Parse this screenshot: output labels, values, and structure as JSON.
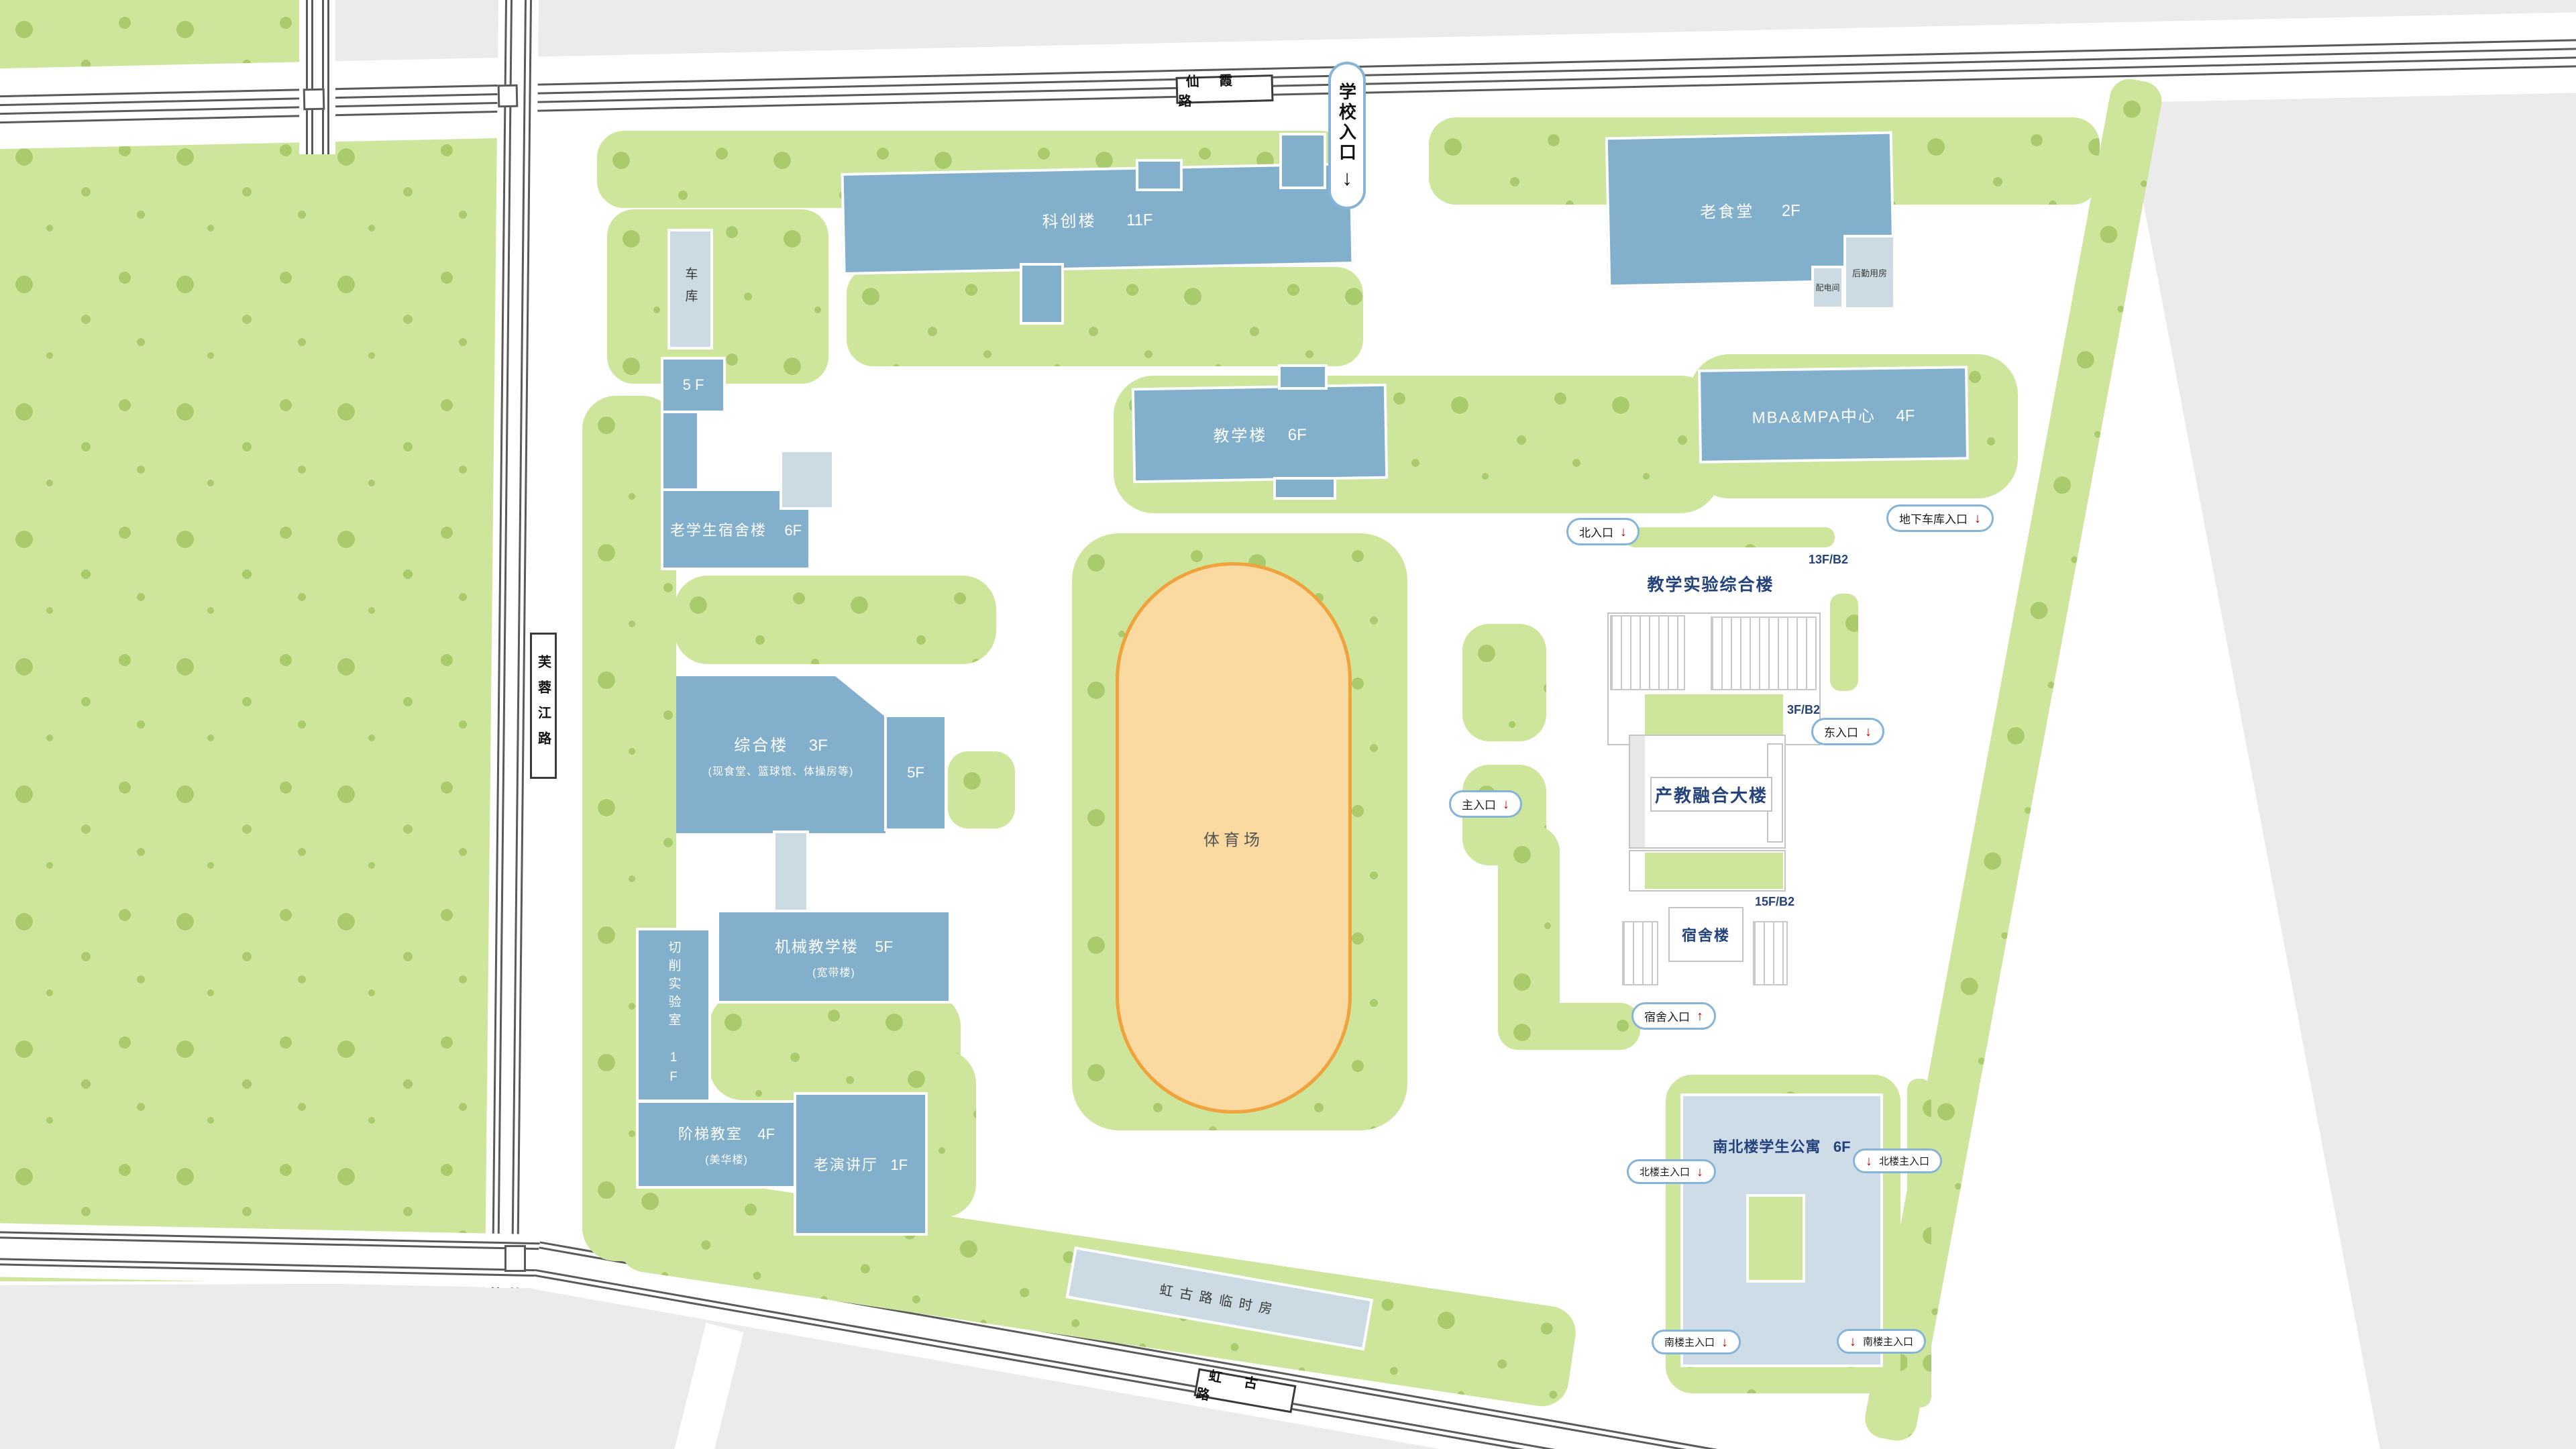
{
  "colors": {
    "campus_green": "#CDE69C",
    "tree_dot": "#A9CB6B",
    "building_blue": "#82AFCC",
    "building_light": "#CBDAE3",
    "apartment_light": "#CDDCE6",
    "outside_gray": "#EBEBEB",
    "stadium_fill": "#FBDAA1",
    "stadium_border": "#F0A23C",
    "navy_text": "#24427C",
    "road_line": "#5A5A5A",
    "pill_border": "#86B4D8",
    "arrow_red": "#C00000"
  },
  "roads": {
    "top": {
      "label": "仙  霞  路"
    },
    "left": {
      "label": "芙蓉江路"
    },
    "bottom": {
      "label": "虹  古  路"
    }
  },
  "school_entrance": {
    "label": "学校入口",
    "arrow": "↓"
  },
  "buildings": {
    "kechuang": {
      "name": "科创楼",
      "floors": "11F"
    },
    "jiaoxuelou": {
      "name": "教学楼",
      "floors": "6F"
    },
    "mba": {
      "name": "MBA&MPA中心",
      "floors": "4F"
    },
    "laoshitang": {
      "name": "老食堂",
      "floors": "2F"
    },
    "peidianjian": {
      "name": "配电间"
    },
    "houqin": {
      "name": "后勤用房"
    },
    "cheku": {
      "name": "车库"
    },
    "wuceng": {
      "name": "5 F"
    },
    "laoxuesheng": {
      "name": "老学生宿舍楼",
      "floors": "6F"
    },
    "zonghelou": {
      "name": "综合楼",
      "floors": "3F",
      "note": "(现食堂、篮球馆、体操房等)"
    },
    "zonghe5f": {
      "name": "5F"
    },
    "qiexiao": {
      "name": "切削实验室 1F"
    },
    "jixie": {
      "name": "机械教学楼",
      "floors": "5F",
      "note": "(宽带楼)"
    },
    "jieti": {
      "name": "阶梯教室",
      "floors": "4F",
      "note": "(美华楼)"
    },
    "laoyanjiangting": {
      "name": "老演讲厅",
      "floors": "1F"
    },
    "tiyuchang": {
      "name": "体育场"
    },
    "jiaoxueshiyan": {
      "name": "教学实验综合楼",
      "spec": "13F/B2"
    },
    "chanjiao": {
      "name": "产教融合大楼",
      "spec": "3F/B2"
    },
    "sushelou": {
      "name": "宿舍楼",
      "spec": "15F/B2"
    },
    "nanbei": {
      "name": "南北楼学生公寓",
      "floors": "6F"
    },
    "linshifang": {
      "name": "虹古路临时房"
    }
  },
  "entrances": {
    "north": {
      "label": "北入口",
      "arrow": "↓"
    },
    "garage": {
      "label": "地下车库入口",
      "arrow": "↓"
    },
    "east": {
      "label": "东入口",
      "arrow": "↓"
    },
    "main": {
      "label": "主入口",
      "arrow": "↓"
    },
    "dorm": {
      "label": "宿舍入口",
      "arrow": "↑"
    },
    "north_bldg_w": {
      "label": "北楼主入口",
      "arrow": "↓"
    },
    "north_bldg_e": {
      "label": "北楼主入口",
      "arrow": "↓"
    },
    "south_bldg_w": {
      "label": "南楼主入口",
      "arrow": "↓"
    },
    "south_bldg_e": {
      "label": "南楼主入口",
      "arrow": "↓"
    }
  }
}
